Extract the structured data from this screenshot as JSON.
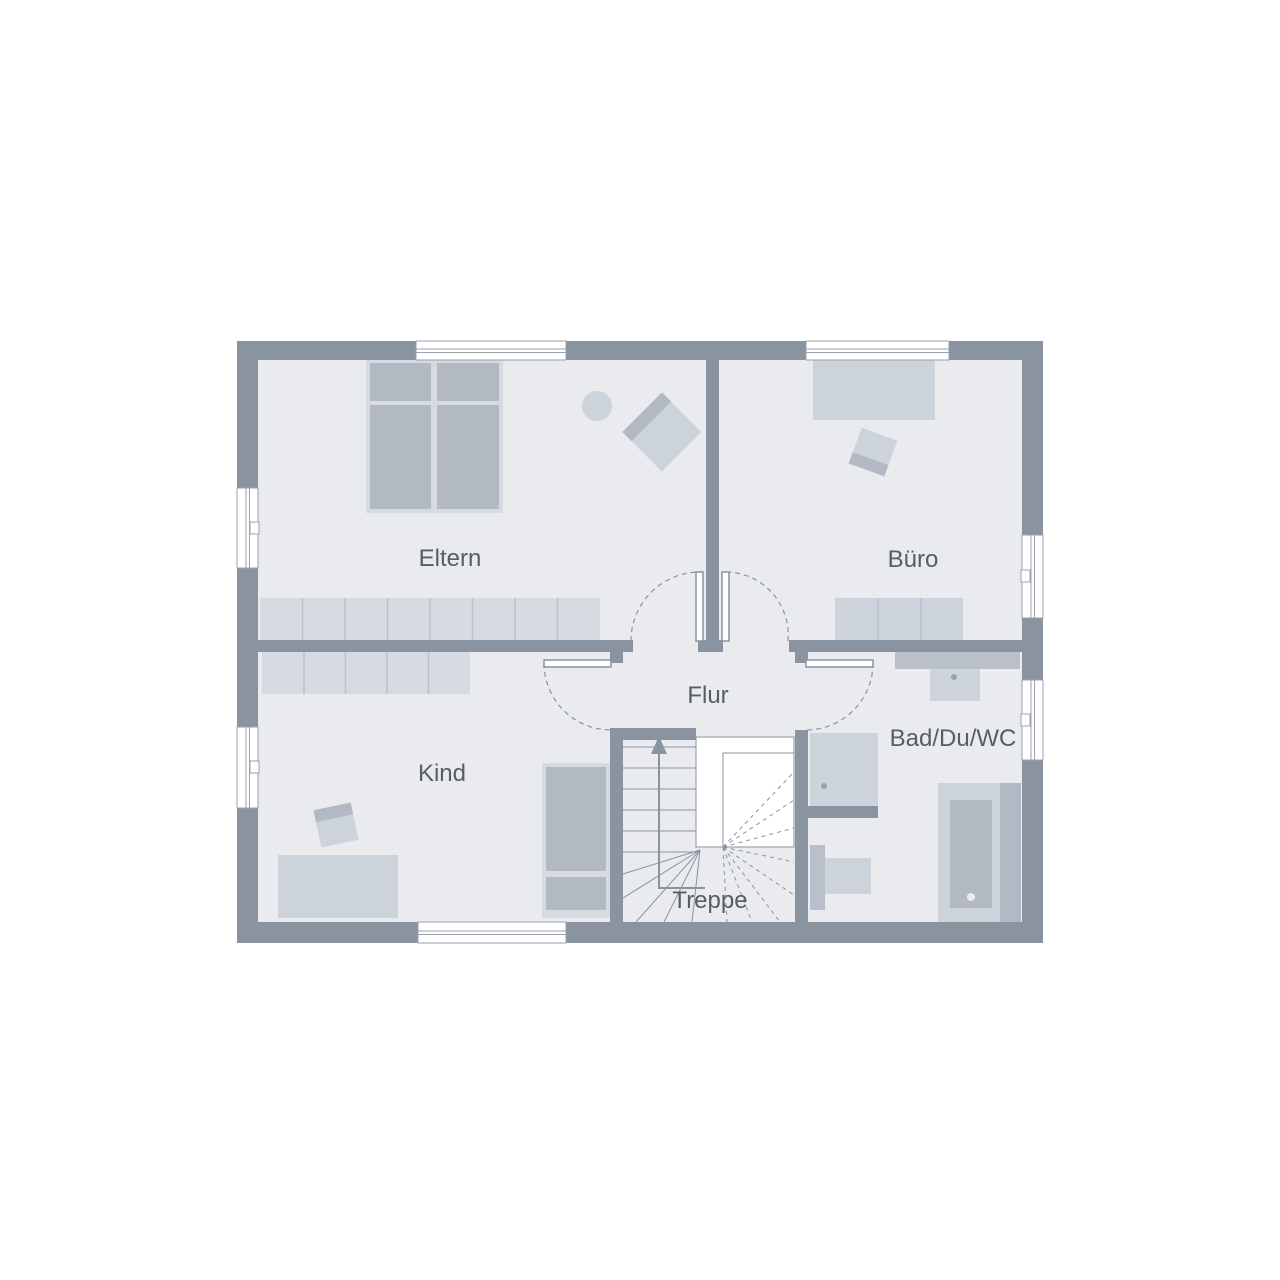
{
  "title": "Obergeschoss Grundriss",
  "colors": {
    "background": "#ffffff",
    "wall": "#8a93a0",
    "floor": "#e9ebef",
    "furniture_light": "#d6dbe1",
    "furniture_mid": "#cdd3da",
    "furniture_dark": "#b2b9c3",
    "fixture_mid": "#b9c0c9",
    "divider": "#bcc2cb",
    "line": "#9aa2ad",
    "label_text": "#575e67",
    "window_fill": "#ffffff"
  },
  "rooms": {
    "eltern": {
      "label": "Eltern"
    },
    "buero": {
      "label": "Büro"
    },
    "kind": {
      "label": "Kind"
    },
    "flur": {
      "label": "Flur"
    },
    "bad": {
      "label": "Bad/Du/WC"
    },
    "treppe": {
      "label": "Treppe"
    }
  },
  "stairs": {
    "direction": "up"
  }
}
